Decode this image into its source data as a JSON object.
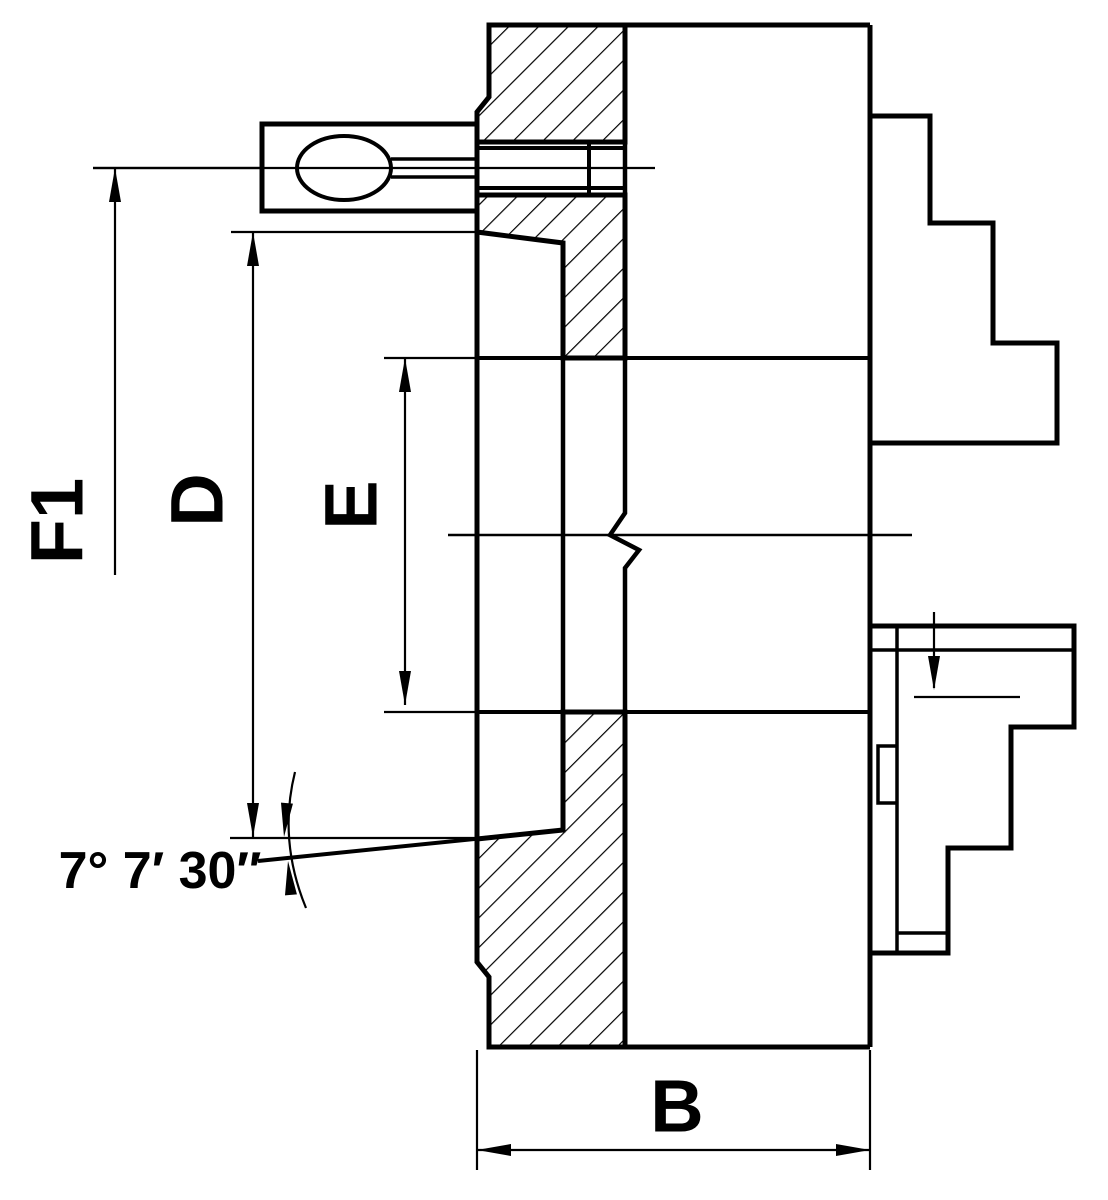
{
  "drawing": {
    "type": "engineering-section-drawing",
    "subject": "Lathe chuck side cross-section with stepped jaws",
    "colors": {
      "line": "#000000",
      "background": "#ffffff"
    },
    "labels": {
      "f1": "F1",
      "d": "D",
      "e": "E",
      "b": "B",
      "taper_angle": "7° 7′ 30″"
    }
  }
}
